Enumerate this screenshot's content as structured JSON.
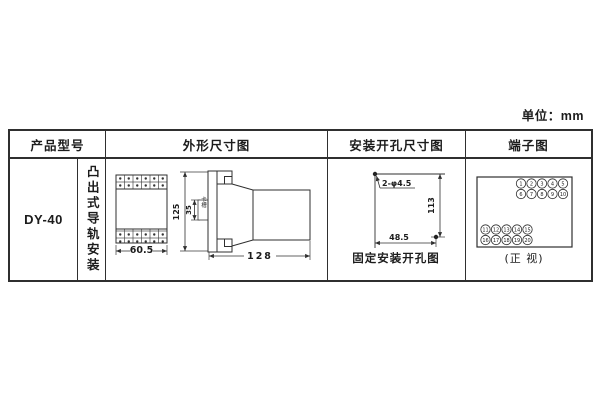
{
  "unit_label": "单位：mm",
  "table": {
    "headers": [
      "产品型号",
      "外形尺寸图",
      "安装开孔尺寸图",
      "端子图"
    ]
  },
  "product": {
    "model": "DY-40",
    "mounting": "凸出式导轨安装"
  },
  "outline_drawing": {
    "front_width": "60.5",
    "total_height": "125",
    "slot_height": "35",
    "slot_label": "卡槽",
    "total_depth": "128"
  },
  "mounting_drawing": {
    "holes_label": "2-φ4.5",
    "hole_v_spacing": "113",
    "hole_h_spacing": "48.5",
    "caption": "固定安装开孔图"
  },
  "terminal_drawing": {
    "caption": "(正 视)",
    "top_rows": [
      [
        "1",
        "2",
        "3",
        "4",
        "5"
      ],
      [
        "6",
        "7",
        "8",
        "9",
        "10"
      ]
    ],
    "bottom_rows": [
      [
        "11",
        "12",
        "13",
        "14",
        "15"
      ],
      [
        "16",
        "17",
        "18",
        "19",
        "20"
      ]
    ]
  }
}
